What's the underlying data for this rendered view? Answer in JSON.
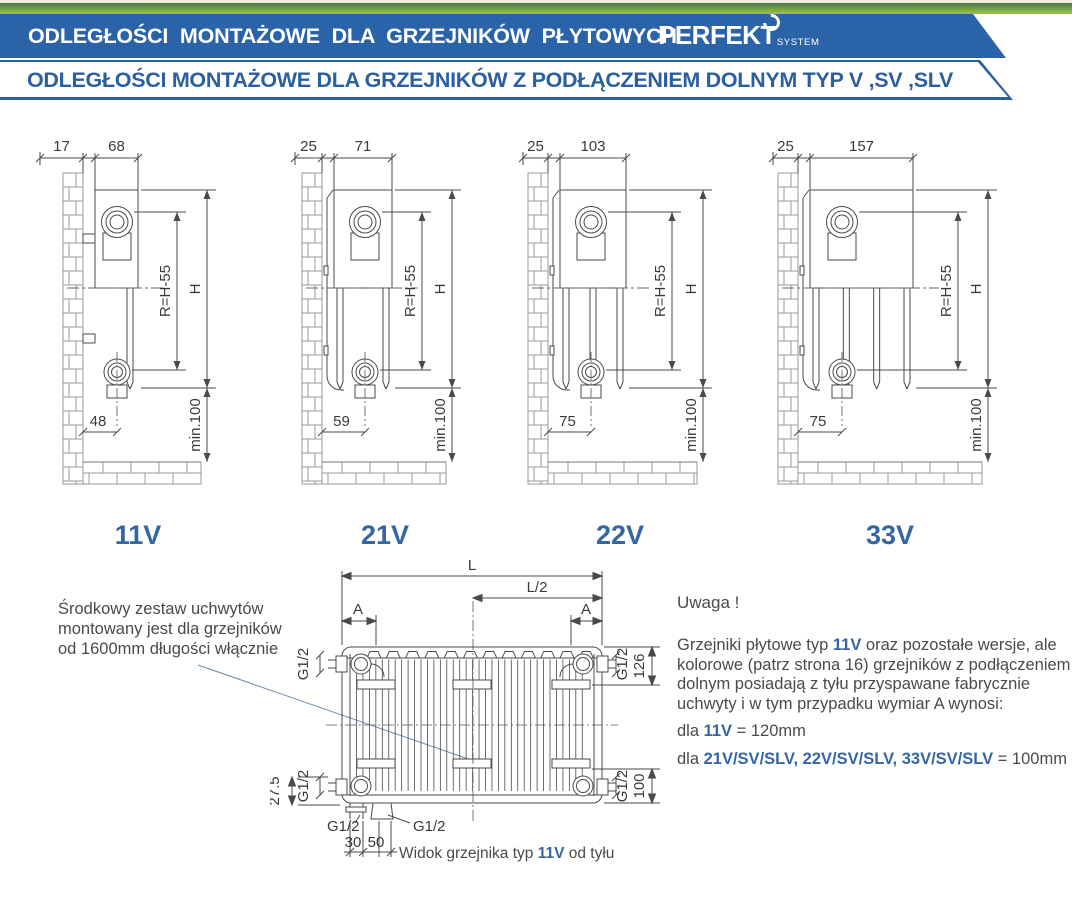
{
  "banner": {
    "title": "ODLEGŁOŚCI MONTAŻOWE DLA GRZEJNIKÓW PŁYTOWYCH",
    "logo": "PERFEKT",
    "logo_sub": "SYSTEM",
    "subtitle": "ODLEGŁOŚCI MONTAŻOWE DLA GRZEJNIKÓW Z PODŁĄCZENIEM DOLNYM TYP V ,SV ,SLV",
    "colors": {
      "strip_green": "#9dc44c",
      "banner_blue": "#2b63a8",
      "subtitle_blue": "#2b5f9f",
      "accent_blue": "#3465a4"
    }
  },
  "sections": [
    {
      "label": "11V",
      "dim_wall": "17",
      "dim_depth": "68",
      "dim_r": "R=H-55",
      "dim_h": "H",
      "dim_min": "min.100",
      "dim_bottom": "48"
    },
    {
      "label": "21V",
      "dim_wall": "25",
      "dim_depth": "71",
      "dim_r": "R=H-55",
      "dim_h": "H",
      "dim_min": "min.100",
      "dim_bottom": "59"
    },
    {
      "label": "22V",
      "dim_wall": "25",
      "dim_depth": "103",
      "dim_r": "R=H-55",
      "dim_h": "H",
      "dim_min": "min.100",
      "dim_bottom": "75"
    },
    {
      "label": "33V",
      "dim_wall": "25",
      "dim_depth": "157",
      "dim_r": "R=H-55",
      "dim_h": "H",
      "dim_min": "min.100",
      "dim_bottom": "75"
    }
  ],
  "note": {
    "lines": [
      "Środkowy zestaw uchwytów",
      "montowany jest dla grzejników",
      "od 1600mm długości włącznie"
    ]
  },
  "rear": {
    "L": "L",
    "L2": "L/2",
    "A": "A",
    "G12": "G1/2",
    "d126": "126",
    "d100": "100",
    "d275": "27.5",
    "d30": "30",
    "d50": "50"
  },
  "caption": {
    "pre": "Widok grzejnika typ ",
    "accent": "11V",
    "post": " od tyłu"
  },
  "uwaga": {
    "title": "Uwaga !",
    "paragraph": [
      [
        {
          "t": "Grzejniki płytowe typ "
        },
        {
          "t": "11V",
          "a": 1
        },
        {
          "t": " oraz pozostałe wersje, ale"
        }
      ],
      [
        {
          "t": "kolorowe (patrz strona 16) grzejników z podłączeniem"
        }
      ],
      [
        {
          "t": "dolnym posiadają z tyłu przyspawane fabrycznie"
        }
      ],
      [
        {
          "t": "uchwyty i w tym przypadku wymiar A wynosi:"
        }
      ]
    ],
    "rules": [
      [
        {
          "t": "dla "
        },
        {
          "t": "11V",
          "a": 1
        },
        {
          "t": " = 120mm"
        }
      ],
      [
        {
          "t": "dla "
        },
        {
          "t": "21V/SV/SLV, 22V/SV/SLV, 33V/SV/SLV",
          "a": 1
        },
        {
          "t": " = 100mm"
        }
      ]
    ]
  }
}
